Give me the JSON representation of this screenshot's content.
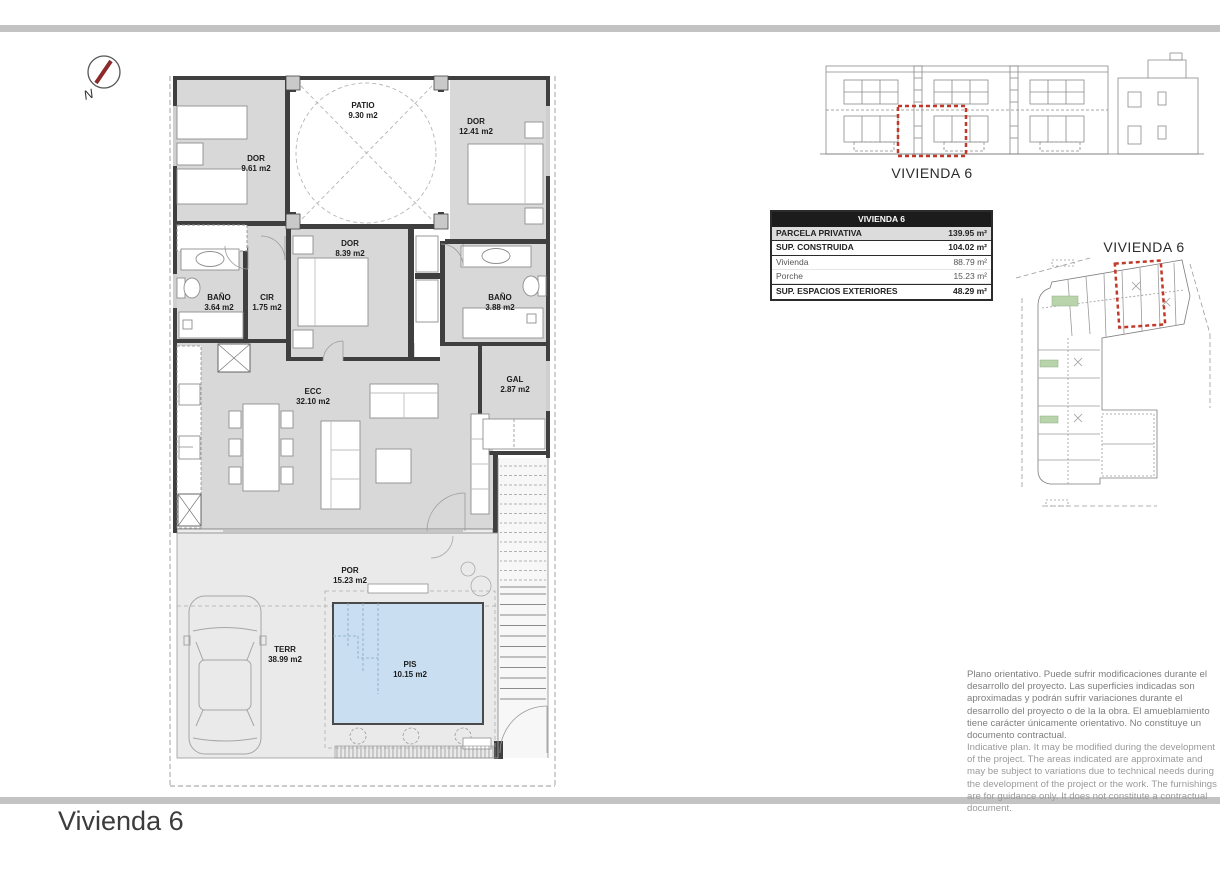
{
  "north": {
    "label": "N"
  },
  "floor_plan": {
    "rooms": [
      {
        "name": "DOR",
        "area": "9.61 m2"
      },
      {
        "name": "PATIO",
        "area": "9.30 m2"
      },
      {
        "name": "DOR",
        "area": "12.41 m2"
      },
      {
        "name": "DOR",
        "area": "8.39 m2"
      },
      {
        "name": "BAÑO",
        "area": "3.64 m2"
      },
      {
        "name": "CIR",
        "area": "1.75 m2"
      },
      {
        "name": "BAÑO",
        "area": "3.88 m2"
      },
      {
        "name": "ECC",
        "area": "32.10 m2"
      },
      {
        "name": "GAL",
        "area": "2.87 m2"
      },
      {
        "name": "POR",
        "area": "15.23 m2"
      },
      {
        "name": "TERR",
        "area": "38.99 m2"
      },
      {
        "name": "PIS",
        "area": "10.15 m2"
      }
    ]
  },
  "elevation": {
    "label": "VIVIENDA 6"
  },
  "site_plan": {
    "label": "VIVIENDA 6"
  },
  "summary_table": {
    "header": "VIVIENDA 6",
    "rows": [
      {
        "label": "PARCELA PRIVATIVA",
        "value": "139.95 m²"
      },
      {
        "label": "SUP. CONSTRUIDA",
        "value": "104.02 m²"
      },
      {
        "label": "Vivienda",
        "value": "88.79 m²"
      },
      {
        "label": "Porche",
        "value": "15.23 m²"
      },
      {
        "label": "SUP. ESPACIOS EXTERIORES",
        "value": "48.29 m²"
      }
    ]
  },
  "disclaimer": {
    "es": "Plano orientativo. Puede sufrir modificaciones durante el desarrollo del proyecto. Las superficies indicadas son aproximadas y podrán sufrir variaciones durante el desarrollo del proyecto o de la la obra. El amueblamiento tiene carácter únicamente orientativo. No constituye un documento contractual.",
    "en": "Indicative plan. It may be modified during the development of the project. The areas indicated are approximate and may be subject to variations due to technical needs during the development of the project or the work. The furnishings are for guidance only. It does not constitute a contractual document."
  },
  "footer": {
    "title": "Vivienda 6"
  },
  "colors": {
    "accent_red": "#c0392b",
    "pool_blue": "#c9def0",
    "wall_dark": "#3f3f3f",
    "floor_gray": "#d8d8d8",
    "terrace_gray": "#eaeaea",
    "title_bar_gray": "#c3c3c3"
  }
}
